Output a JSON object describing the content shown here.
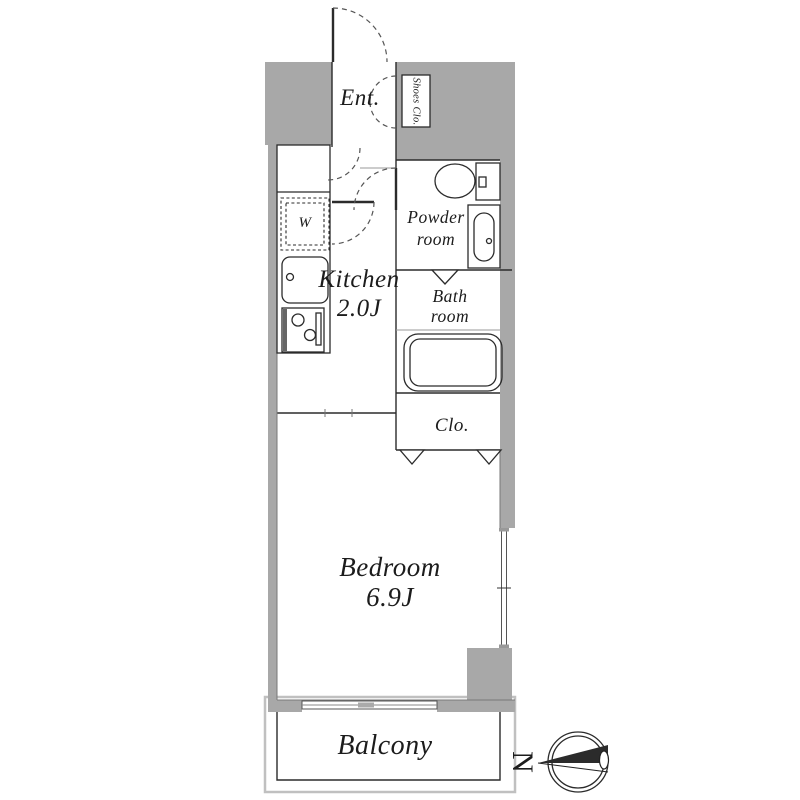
{
  "rooms": {
    "entrance": {
      "label": "Ent."
    },
    "shoes_closet": {
      "label": "Shoes Clo."
    },
    "powder_room": {
      "line1": "Powder",
      "line2": "room"
    },
    "bath_room": {
      "line1": "Bath",
      "line2": "room"
    },
    "kitchen": {
      "line1": "Kitchen",
      "line2": "2.0J"
    },
    "closet": {
      "label": "Clo."
    },
    "bedroom": {
      "line1": "Bedroom",
      "line2": "6.9J"
    },
    "balcony": {
      "label": "Balcony"
    },
    "washer_space": {
      "label": "W"
    }
  },
  "compass": {
    "label": "N"
  },
  "colors": {
    "wall": "#a8a8a8",
    "line": "#2b2b2b",
    "light_line": "#9a9a9a",
    "balcony_border": "#c0c0c0",
    "text": "#1c1c1c",
    "background": "#ffffff"
  }
}
